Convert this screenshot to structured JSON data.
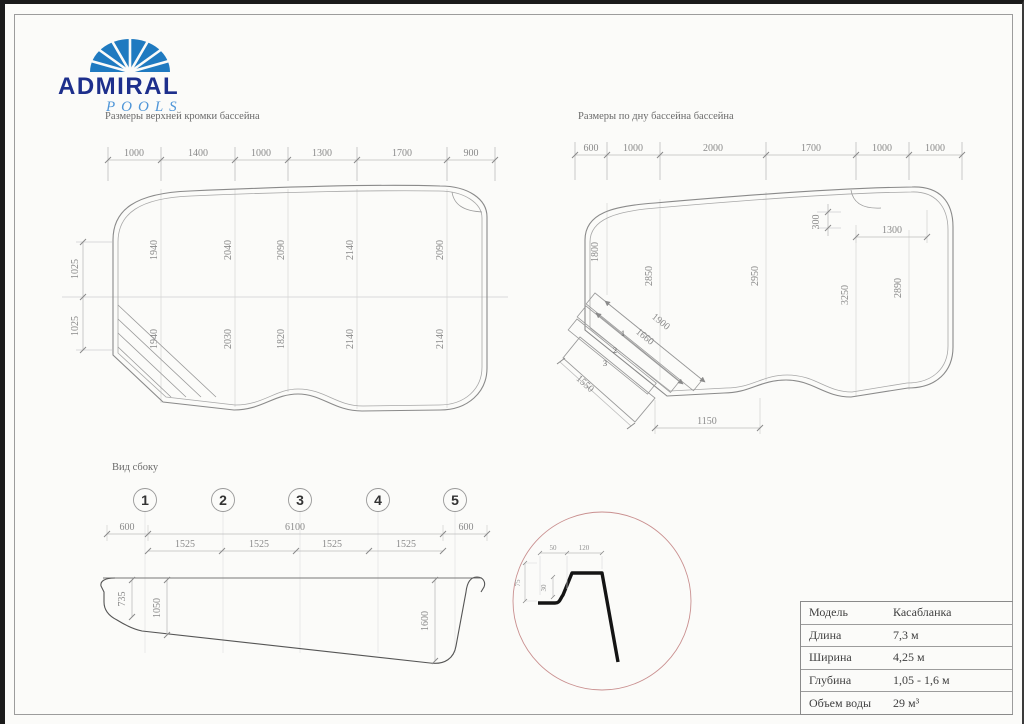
{
  "logo": {
    "name": "ADMIRAL",
    "sub": "POOLS"
  },
  "colors": {
    "brand_navy": "#1d2f8c",
    "brand_blue": "#1f7ac0",
    "logo_script_blue": "#4f96d8",
    "detail_circle_red": "#c98f8f",
    "drawing_line_gray": "#8a8a8a"
  },
  "top_plan": {
    "title": "Размеры верхней кромки бассейна",
    "width_dims": [
      "1000",
      "1400",
      "1000",
      "1300",
      "1700",
      "900"
    ],
    "left_dims": [
      "1025",
      "1025"
    ],
    "upper_row": [
      "1940",
      "2040",
      "2090",
      "2140",
      "2090"
    ],
    "lower_row": [
      "1940",
      "2030",
      "1820",
      "2140",
      "2140"
    ]
  },
  "bottom_plan": {
    "title": "Размеры по дну бассейна бассейна",
    "width_dims": [
      "600",
      "1000",
      "2000",
      "1700",
      "1000",
      "1000"
    ],
    "col_dims": [
      "1800",
      "2850",
      "2950",
      "3250",
      "2890"
    ],
    "dim_300": "300",
    "dim_1300": "1300",
    "dim_1150": "1150",
    "stair_dims": [
      "1900",
      "1660",
      "1550"
    ],
    "step_labels": [
      "1",
      "2",
      "3"
    ]
  },
  "side_view": {
    "title": "Вид сбоку",
    "markers": [
      "1",
      "2",
      "3",
      "4",
      "5"
    ],
    "row1": [
      "600",
      "6100",
      "600"
    ],
    "row2": [
      "1525",
      "1525",
      "1525",
      "1525"
    ],
    "depths": [
      "735",
      "1050",
      "1600"
    ]
  },
  "detail": {
    "dims": [
      "50",
      "120",
      "30",
      "75"
    ]
  },
  "spec_table": {
    "rows": [
      {
        "label": "Модель",
        "value": "Касабланка"
      },
      {
        "label": "Длина",
        "value": "7,3 м"
      },
      {
        "label": "Ширина",
        "value": "4,25 м"
      },
      {
        "label": "Глубина",
        "value": "1,05 - 1,6 м"
      },
      {
        "label": "Объем воды",
        "value": "29 м³"
      }
    ]
  }
}
